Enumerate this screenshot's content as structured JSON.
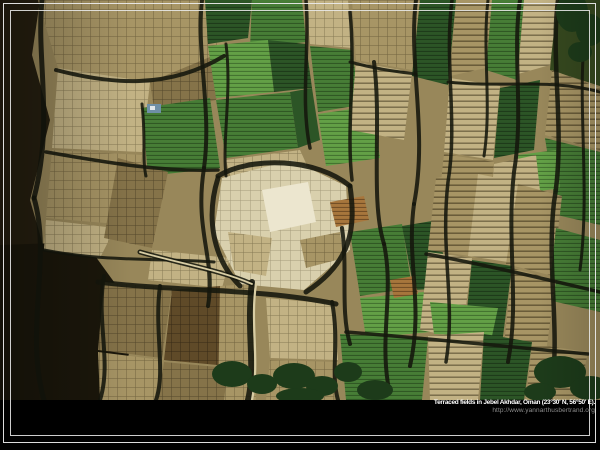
{
  "window": {
    "background": "#000000"
  },
  "caption": {
    "title": "Terraced fields in Jebel Akhdar, Oman (23°30' N, 56°50' E).",
    "url": "http://www.yannarthusbertrand.org"
  },
  "photo": {
    "alt": "Aerial photograph of terraced agricultural fields: mosaic of green crop plots, tan fallow terraces, pale gridded fields and dark stone-wall shadows",
    "palette": {
      "base": "#98875a",
      "tanLight": "#c2b284",
      "tanMid": "#a79565",
      "tanDark": "#857349",
      "cream": "#d9d0ad",
      "creamBright": "#ece6cf",
      "greenDark": "#2c5526",
      "greenMid": "#477d36",
      "greenBright": "#63a046",
      "oliveDark": "#36491f",
      "rust": "#a7763c",
      "brown": "#5f4a28",
      "seam": "#14170d",
      "cliff": "#261f10",
      "cliffDark": "#1b170b",
      "blue": "#6f8fa6",
      "pathLight": "#d8cda4",
      "treeGreen": "#1d3b1a",
      "frame": "#e9e9e9",
      "captionTitle": "#ffffff",
      "captionUrl": "#8d8d8d"
    }
  }
}
